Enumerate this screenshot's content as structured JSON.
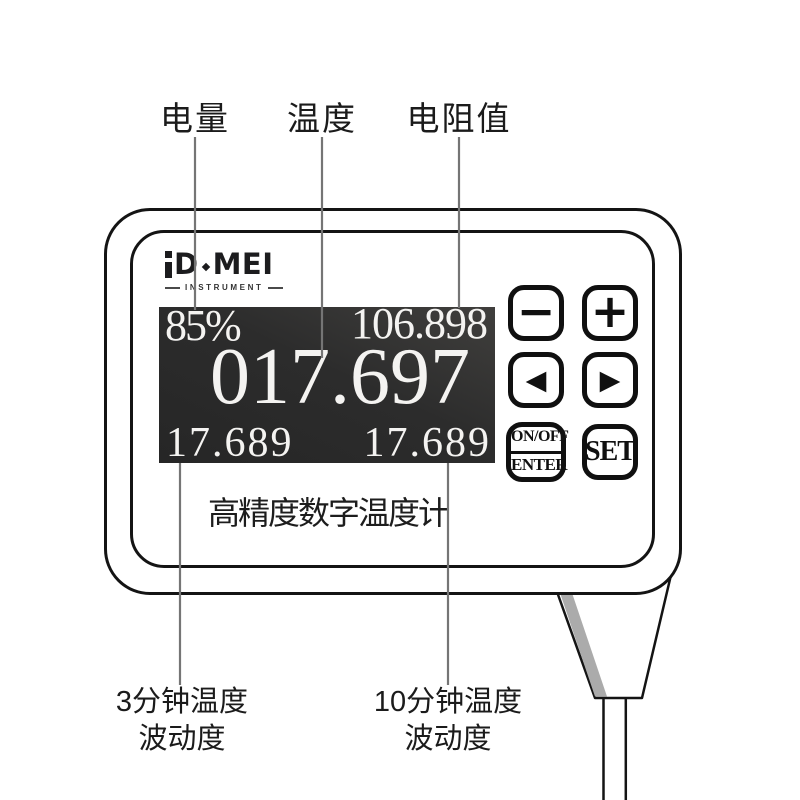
{
  "labels": {
    "battery": "电量",
    "temperature": "温度",
    "resistance": "电阻值",
    "fluct3_line1": "3分钟温度",
    "fluct3_line2": "波动度",
    "fluct10_line1": "10分钟温度",
    "fluct10_line2": "波动度"
  },
  "brand": {
    "d": "D",
    "mei": "MEI",
    "sub": "INSTRUMENT"
  },
  "display": {
    "battery_percent": "85%",
    "resistance_value": "106.898",
    "main_temperature": "017.697",
    "fluctuation_3min": "17.689",
    "fluctuation_10min": "17.689"
  },
  "device_caption": "高精度数字温度计",
  "buttons": {
    "minus": "−",
    "plus": "+",
    "prev": "◀",
    "next": "▶",
    "onoff": "ON/OFF",
    "enter": "ENTER",
    "set": "SET"
  },
  "colors": {
    "screen_bg": "#2c2c2c",
    "screen_text": "#f4f3f1",
    "outline": "#141414",
    "callout_line": "#757575",
    "cable_shadow": "#ababab"
  }
}
